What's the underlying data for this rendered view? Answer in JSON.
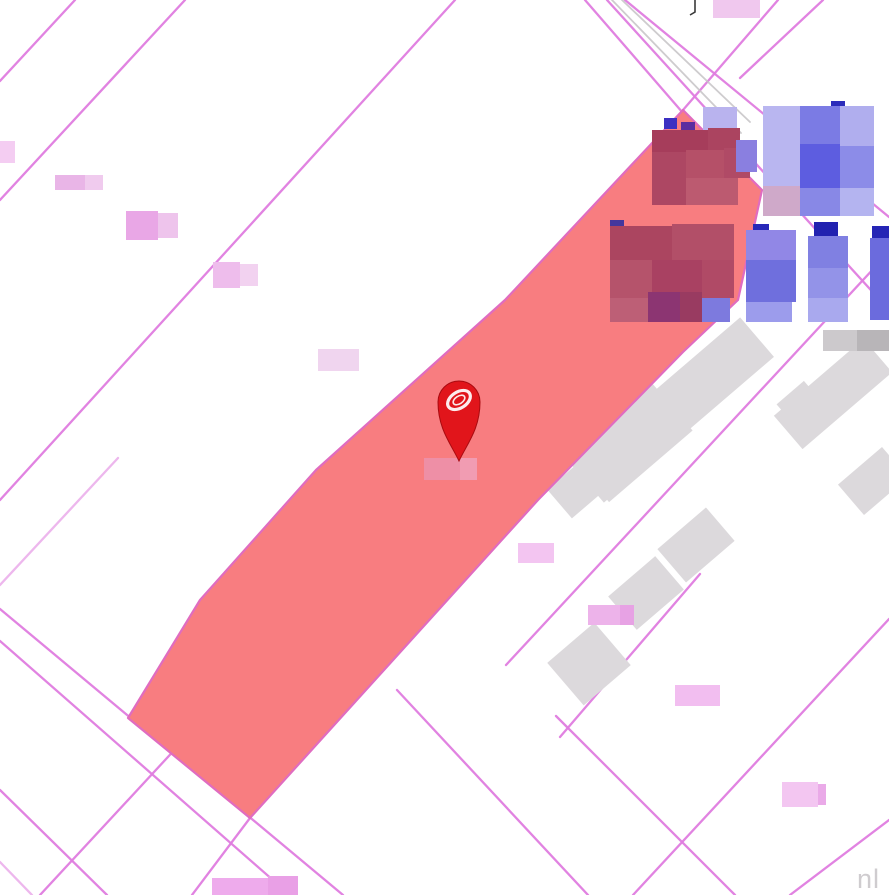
{
  "map": {
    "watermark_text": "nl",
    "colors": {
      "background": "#ffffff",
      "boundary_line": "#df7cdf",
      "road_gray_line": "#c6c3c6",
      "selected_parcel_fill": "#f87d80",
      "selected_parcel_edge": "#e06cc0",
      "building_footprint_gray": "#dcd9dc",
      "pin_red": "#e1151b",
      "pin_outline": "#a80b10",
      "pin_inner_swirl": "#ffffff",
      "pin_label_pink": "#ee8fa6",
      "pin_label_pink_light": "#f19cb2",
      "blurred_label_pink": "#eec2ec",
      "watermark_gray": "#cfcccf",
      "symbol_dark": "#3a3a3a"
    }
  }
}
